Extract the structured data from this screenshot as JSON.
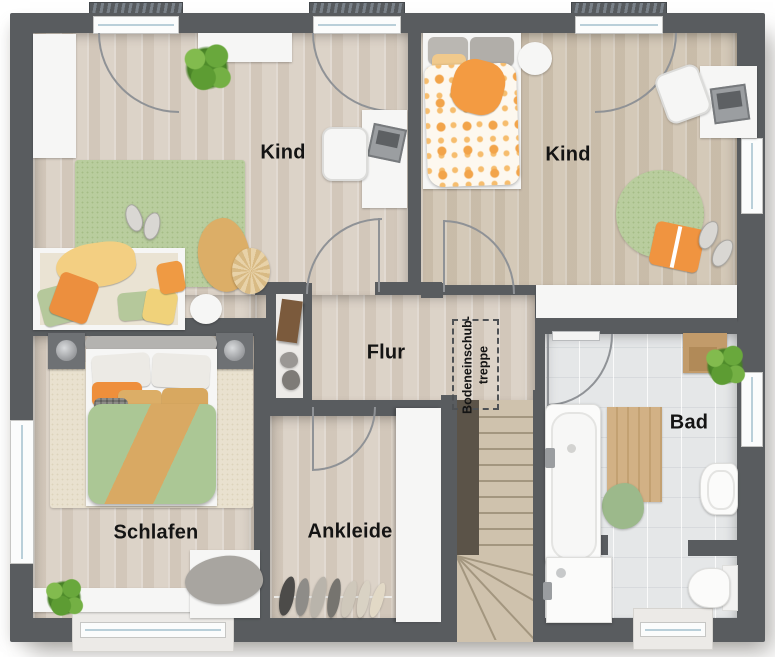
{
  "plan": {
    "type": "floor-plan-upper-storey",
    "rooms": {
      "kind_left": {
        "label": "Kind"
      },
      "kind_right": {
        "label": "Kind"
      },
      "flur": {
        "label": "Flur"
      },
      "schlafen": {
        "label": "Schlafen"
      },
      "ankleide": {
        "label": "Ankleide"
      },
      "bad": {
        "label": "Bad"
      },
      "loft_ladder": {
        "line1": "Bodeneinschub-",
        "line2": "treppe"
      }
    },
    "colors": {
      "wall": "#595c5f",
      "wood_floor_light": "#d9cfc3",
      "wood_floor_warm": "#d1c5b3",
      "bath_tile": "#e5e7e8",
      "stair_wood": "#cfc2ad",
      "rug_green": "#b9cd9e",
      "rug_cream": "#e9e1cf",
      "duvet_green": "#abc795",
      "accent_orange": "#ee9440",
      "accent_tan": "#dcae67",
      "white_furniture": "#f6f6f5",
      "label_text": "#141414"
    }
  }
}
